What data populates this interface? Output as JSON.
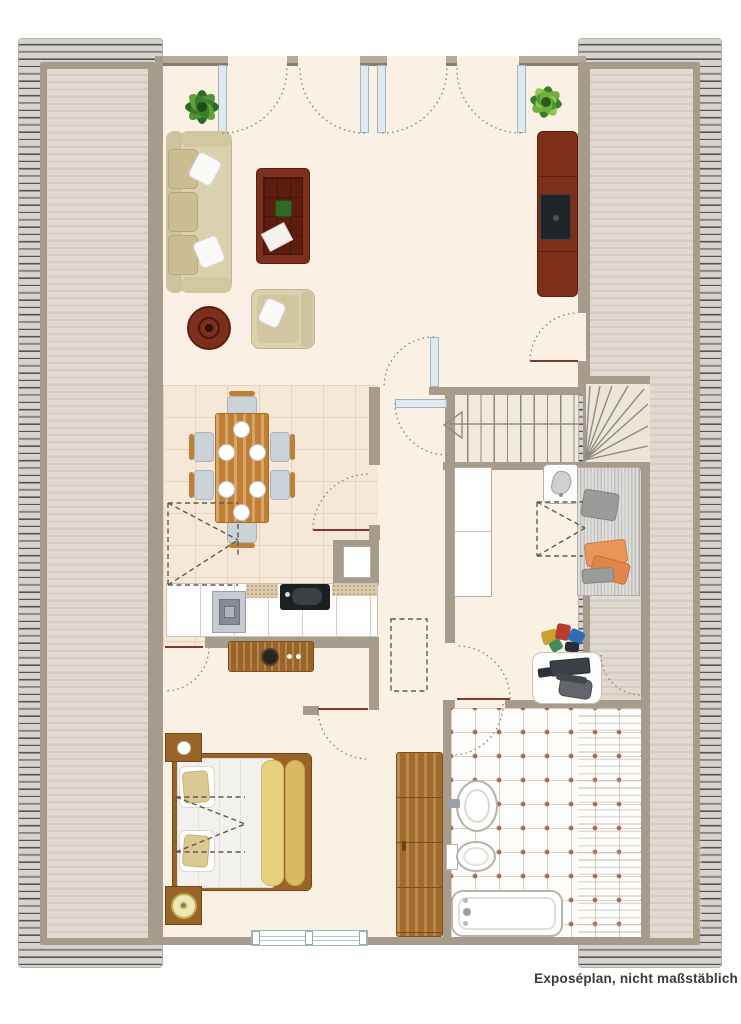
{
  "caption": {
    "text": "Exposéplan, nicht maßstäblich"
  },
  "watermark": {
    "text": "Illustration © ImmoGrafik"
  },
  "colors": {
    "wall": "#a79b8b",
    "wall_light": "#b7a996",
    "wall_edge": "#8a7c6c",
    "floor": "#fbf0e4",
    "panel": "#e0dad0",
    "panel_stripe": "#d4cec2",
    "hatch_light": "#d6d3ce",
    "hatch_dark": "#55534f",
    "tile_dining": "#f6e8d9",
    "tile_grid": "#e8d2be",
    "bath_tile": "#fefdfc",
    "bath_grid": "#d9cfc5",
    "bath_dot": "#a96a52",
    "wood_light": "#c07f35",
    "wood_mid": "#9a6428",
    "wood_dark": "#7c2f1d",
    "sofa": "#dcd1ae",
    "sofa_dark": "#cfc29e",
    "leaf_border": "#9fb6c2",
    "leafline": "#7b3a2b",
    "arc": "#8b8277",
    "dash": "#5f5a50",
    "accent_orange": "#e8965a",
    "plant_dark": "#2e6b22",
    "plant_mid": "#4f9431",
    "plant_light": "#8cc84b",
    "text": "#3a3a3a"
  }
}
